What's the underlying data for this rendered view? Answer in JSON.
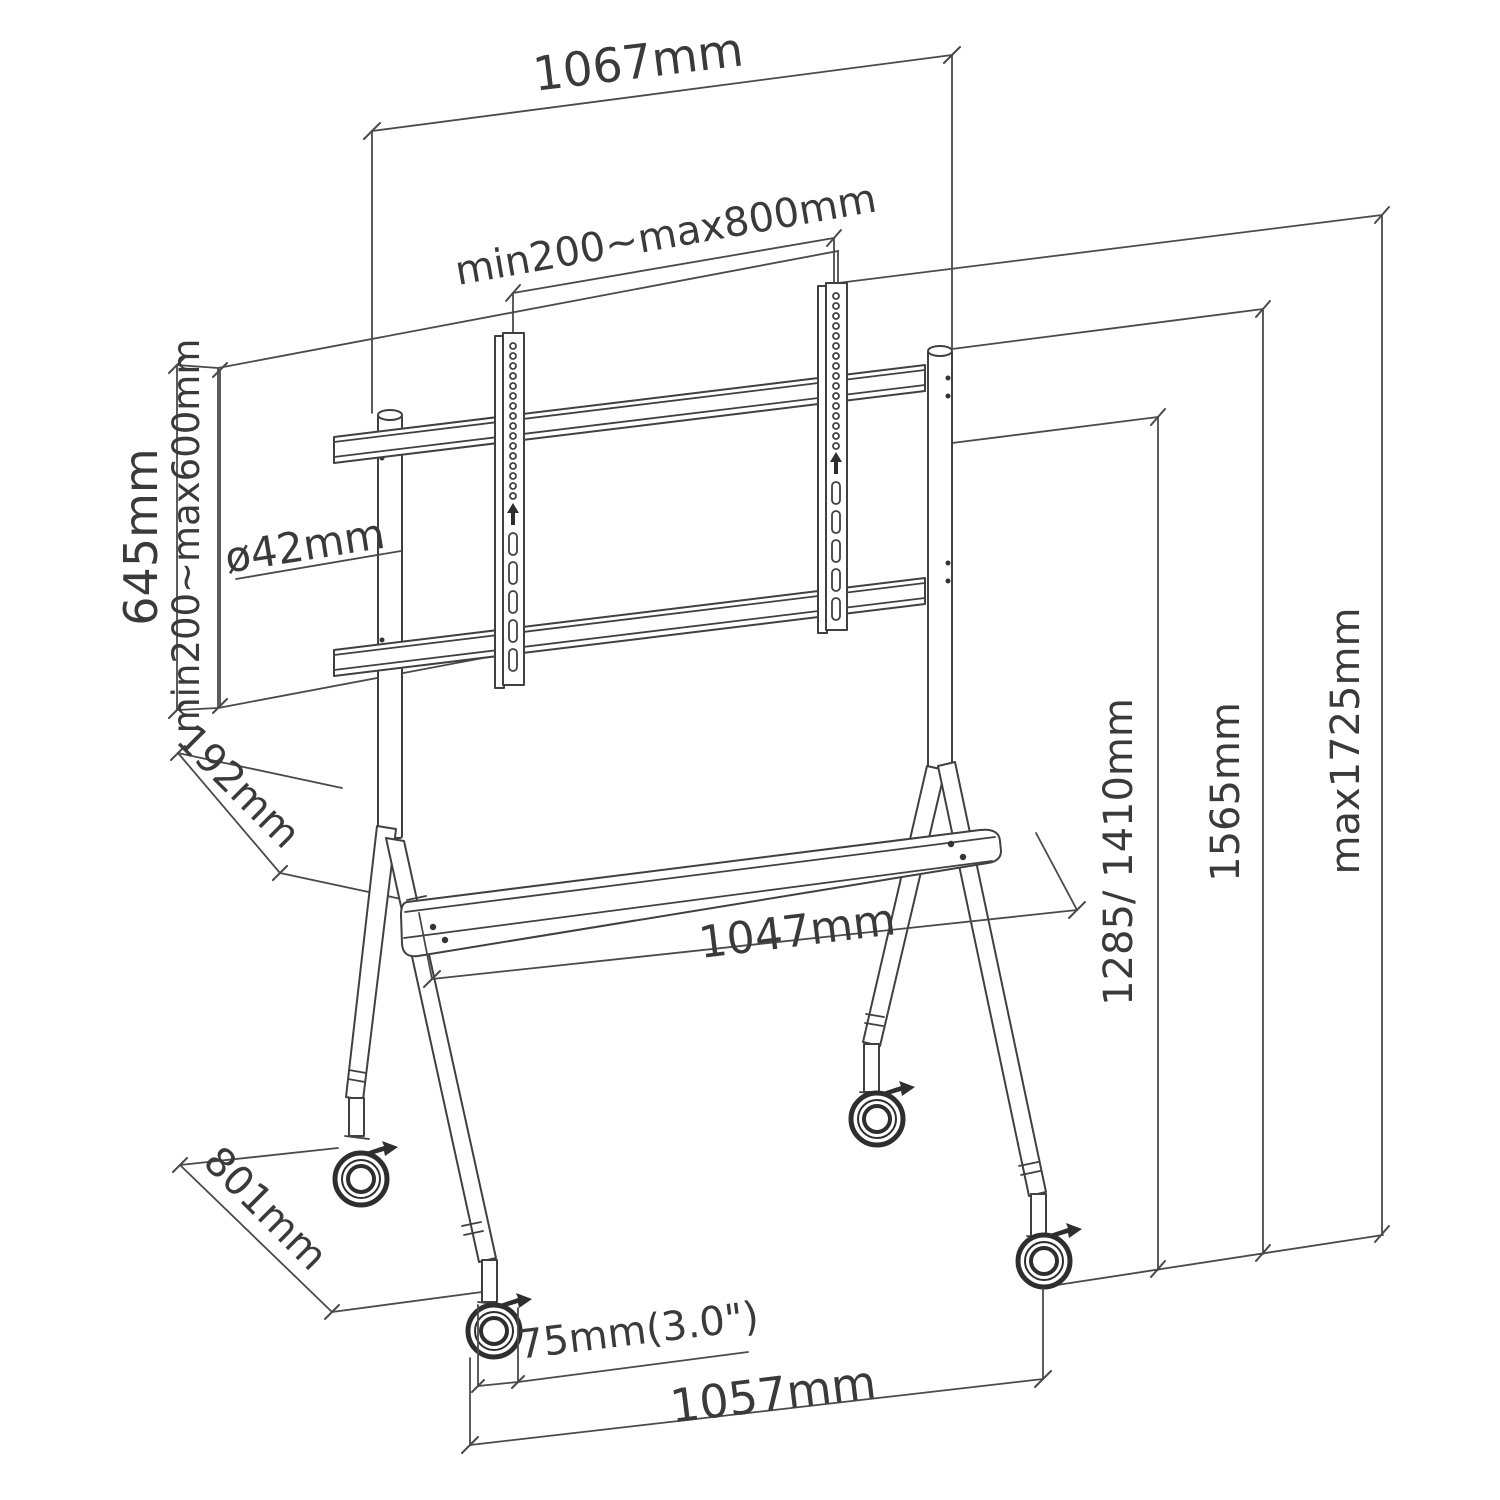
{
  "diagram": {
    "type": "technical-line-drawing",
    "subject": "Mobile TV / interactive display floor stand with casters, isometric dimension drawing",
    "colors": {
      "line": "#454545",
      "text": "#3a3a3a",
      "background": "#ffffff"
    },
    "dims": {
      "top_width": "1067mm",
      "vesa_width_range": "min200~max800mm",
      "bracket_column_height": "645mm",
      "vesa_height_range": "min200~max600mm",
      "pole_diameter": "ø42mm",
      "shelf_depth": "192mm",
      "shelf_length": "1047mm",
      "screen_center_heights": "1285/ 1410mm",
      "frame_height": "1565mm",
      "max_total_height": "max1725mm",
      "base_depth": "801mm",
      "caster_size": "75mm(3.0\")",
      "base_width": "1057mm"
    }
  }
}
